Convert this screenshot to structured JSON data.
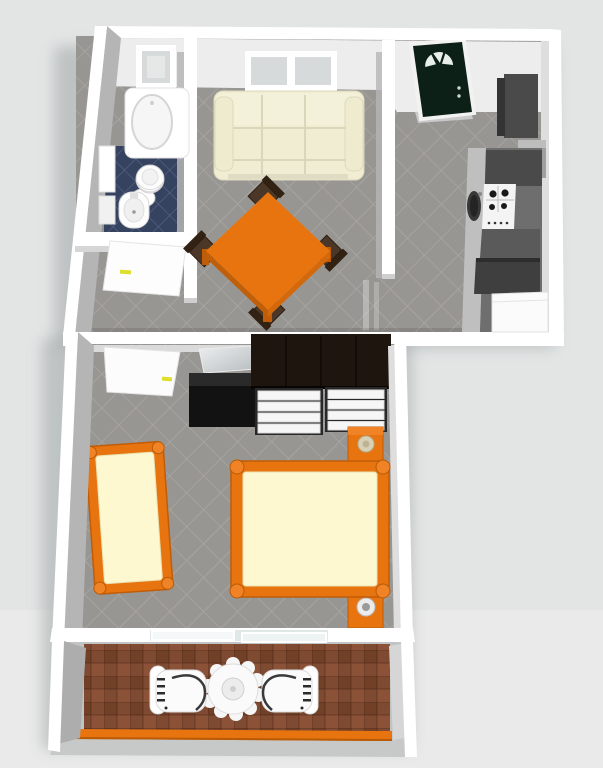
{
  "scene": {
    "type": "3d-floorplan-render",
    "view": "top-down perspective apartment rendering, no visible text",
    "units": [
      {
        "name": "main-unit",
        "rooms": [
          {
            "name": "bathroom",
            "floor": "blue-tile",
            "fixtures": [
              "small-window",
              "bathtub",
              "wall-cabinet",
              "toilet",
              "pedestal-sink",
              "open-white-door"
            ]
          },
          {
            "name": "living-dining-room",
            "floor": "gray-diagonal-tile",
            "fixtures": [
              "double-window",
              "cream-three-seat-sofa",
              "orange-square-dining-table",
              "four-dark-wood-chairs"
            ]
          },
          {
            "name": "kitchen-hall",
            "floor": "gray-diagonal-tile",
            "fixtures": [
              "dark-green-entry-door-with-fanlight",
              "tall-dark-cabinet",
              "counter-run",
              "white-cooktop-with-burners",
              "dark-sink-basin",
              "dark-refrigerator-cabinet",
              "white-appliance"
            ]
          }
        ]
      },
      {
        "name": "bedroom",
        "floor": "gray-diagonal-tile",
        "fixtures": [
          "open-white-door",
          "leaning-wall-mirror",
          "black-sideboard",
          "dark-wardrobe",
          "white-drawer-chest-left",
          "white-drawer-chest-right",
          "orange-nightstand-top",
          "orange-nightstand-bottom",
          "table-lamp-beige",
          "table-lamp-gray",
          "orange-double-bed",
          "orange-single-bed"
        ]
      },
      {
        "name": "balcony",
        "floor": "red-brick-checker-tile",
        "fixtures": [
          "sliding-glass-door",
          "white-round-patio-table",
          "white-patio-chair-left",
          "white-patio-chair-right",
          "orange-railing"
        ]
      }
    ]
  },
  "colors": {
    "bg": "#e3e5e5",
    "bg2": "#ecedec",
    "shadow": "#9aa0a0",
    "wall": "#ffffff",
    "wall_face": "#ededee",
    "wall_side": "#b5b5b5",
    "wall_light": "#dedede",
    "floor": "#989693",
    "grout": "#adaaa5",
    "bath_floor": "#354260",
    "bath_grout": "#5d6c8d",
    "orange": "#e87410",
    "orange_dark": "#c05c08",
    "orange_hi": "#f08326",
    "cream": "#f0edd2",
    "cream_line": "#d9d6ba",
    "mattress": "#fdf8d0",
    "mattress_line": "#e9e2b2",
    "wood": "#1e150e",
    "black": "#121212",
    "drawer": "#f6f6f6",
    "drawer_frame": "#282828",
    "door_green": "#0d2017",
    "brick_a": "#7f4a32",
    "brick_b": "#714026",
    "brick_c": "#8c5238",
    "white": "#fafafa",
    "pane": "#d7dada",
    "k_dark": "#4a4a4a",
    "k_mid": "#6e6e6e",
    "k_counter": "#bfbfbf",
    "k_steel": "#9f9f9f",
    "handle_yellow": "#dede2e"
  }
}
